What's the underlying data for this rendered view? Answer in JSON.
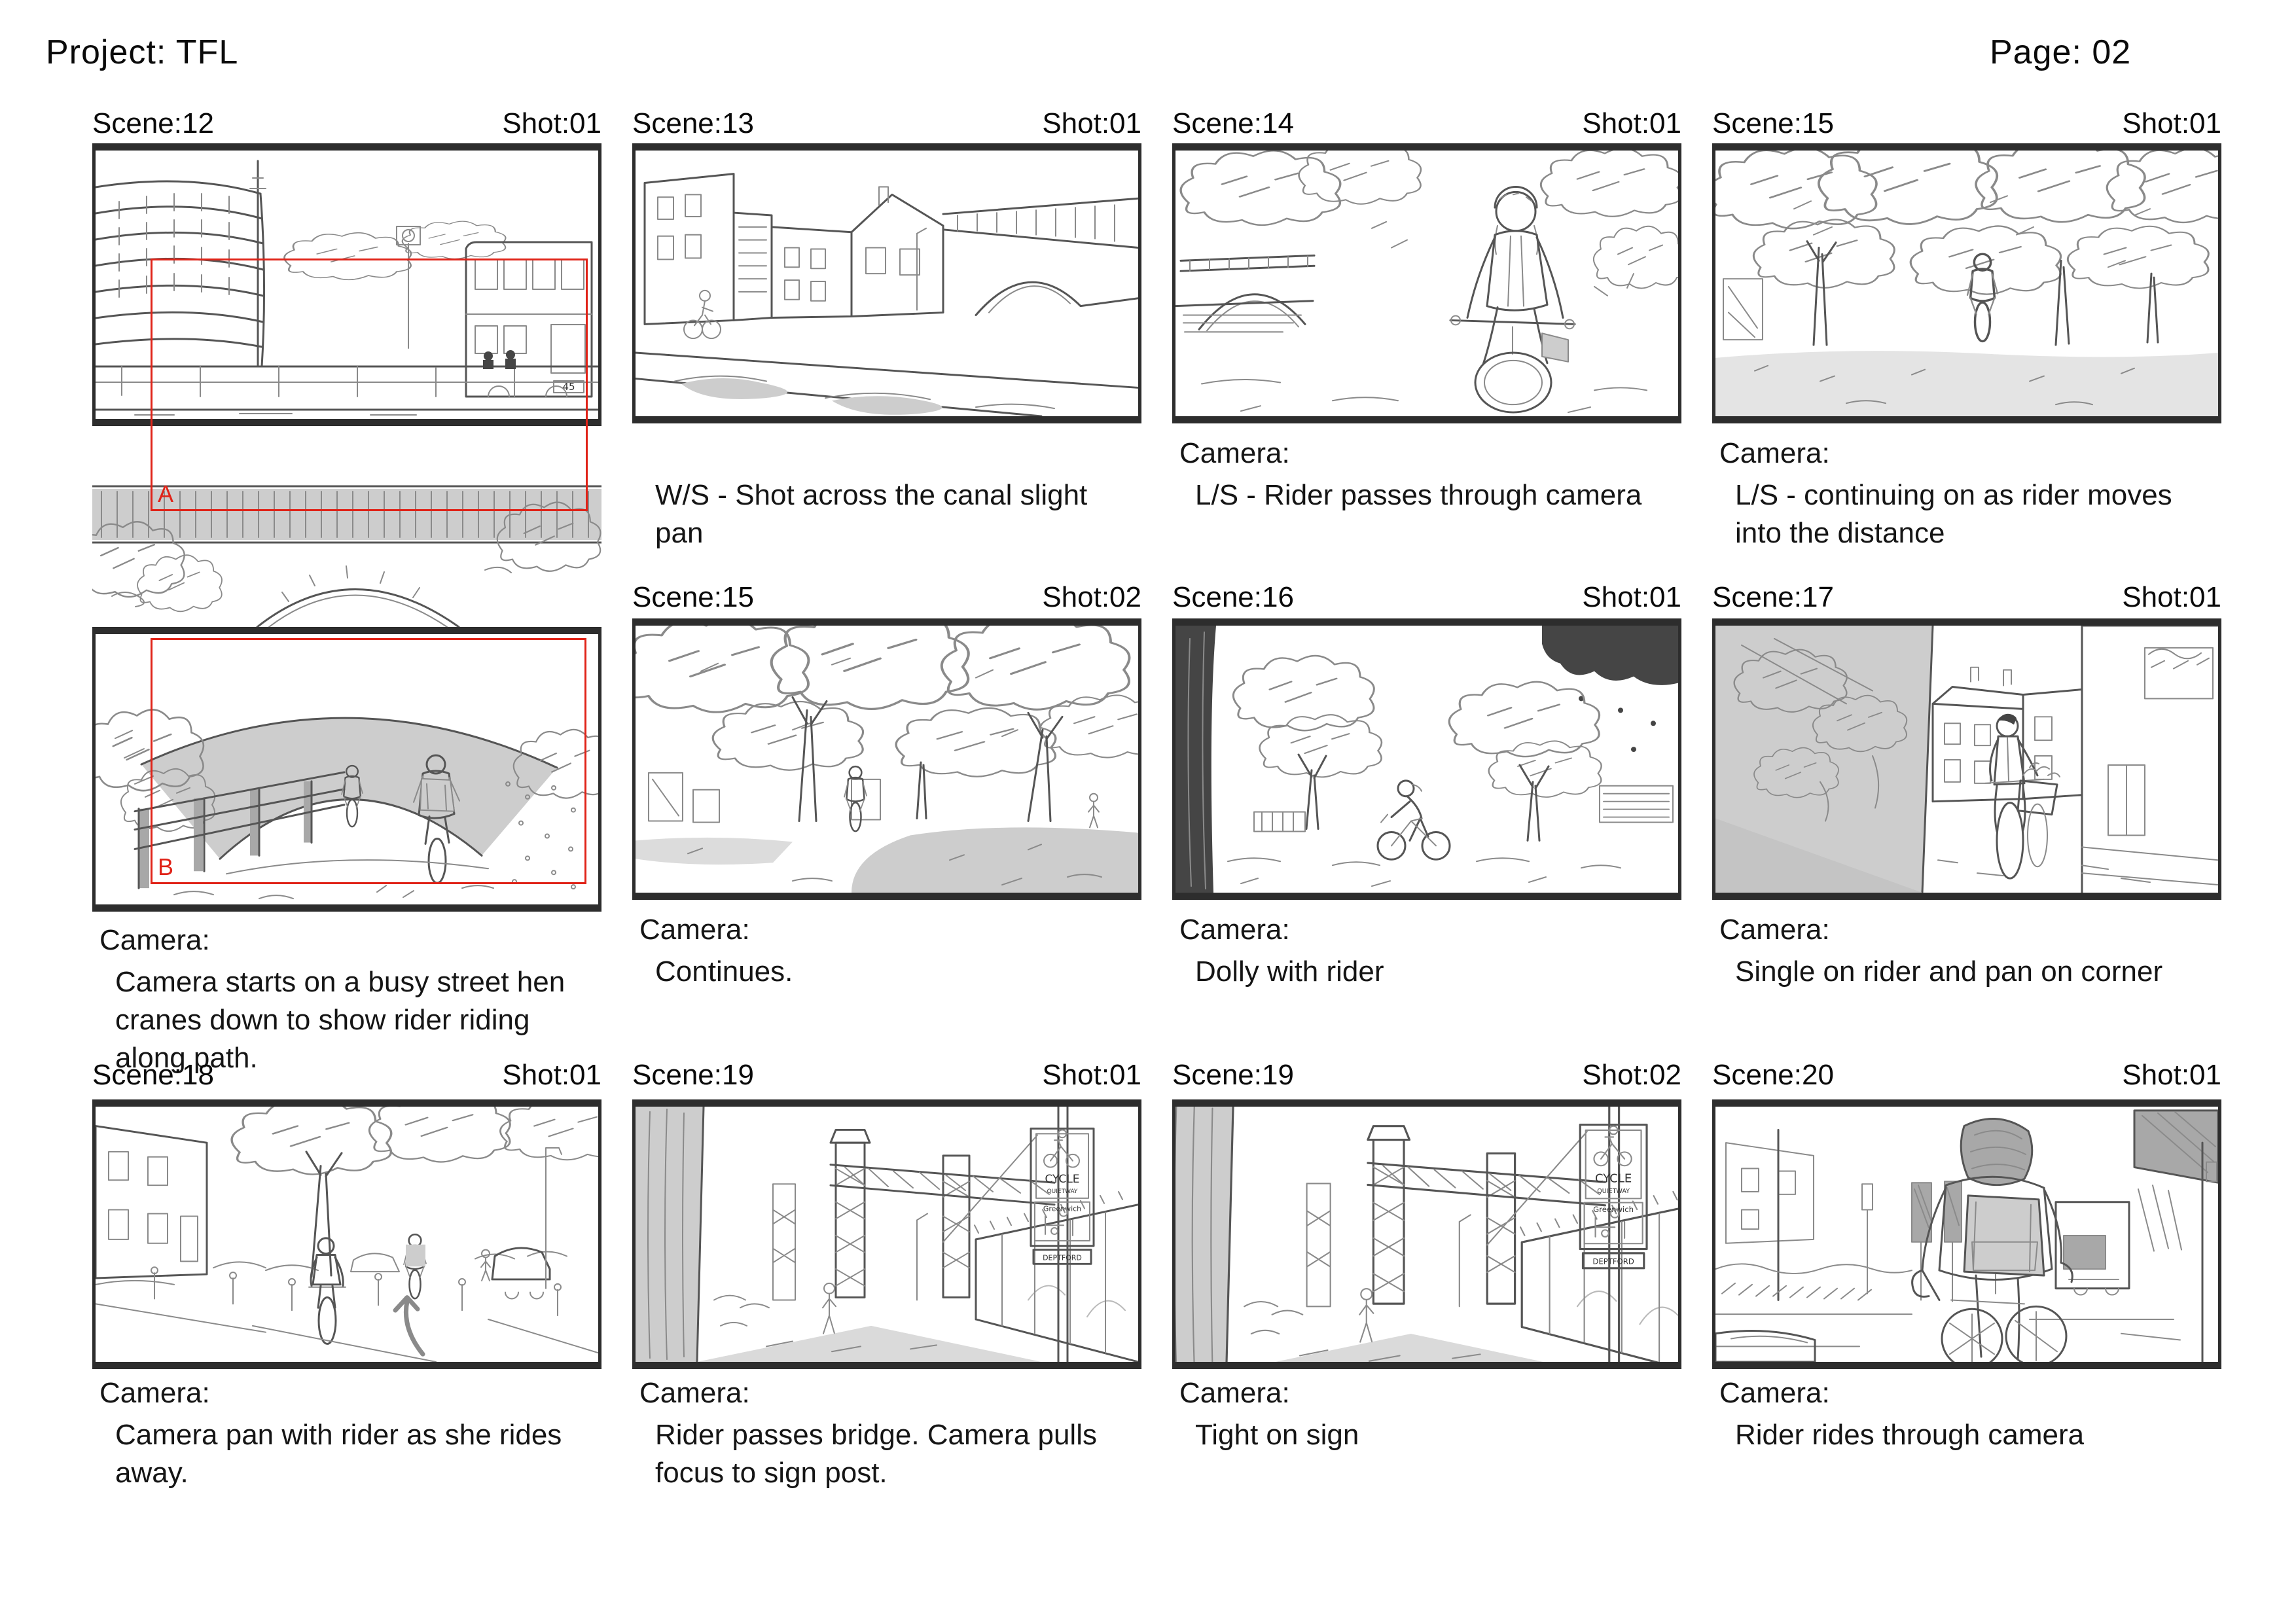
{
  "header": {
    "project_label": "Project: TFL",
    "page_label": "Page: 02"
  },
  "colors": {
    "frame_border": "#2d2d2d",
    "marker_red": "#e02318",
    "sketch_line": "#555555",
    "sketch_shade": "#cdcdcd"
  },
  "panels": [
    {
      "scene": "Scene:12",
      "shot": "Shot:01",
      "camera_label": "Camera:",
      "camera_text": "Camera starts on a busy street hen cranes down to show rider riding along path.",
      "overlay_labels": {
        "frame_a": "A",
        "frame_b": "B"
      },
      "sketch_text": {
        "bus_number": "45"
      }
    },
    {
      "scene": "Scene:13",
      "shot": "Shot:01",
      "camera_label": "",
      "camera_text": "W/S - Shot across the canal slight pan"
    },
    {
      "scene": "Scene:14",
      "shot": "Shot:01",
      "camera_label": "Camera:",
      "camera_text": "L/S - Rider passes through camera"
    },
    {
      "scene": "Scene:15",
      "shot": "Shot:01",
      "camera_label": "Camera:",
      "camera_text": "L/S - continuing on as rider moves into the distance"
    },
    {
      "scene": "Scene:15",
      "shot": "Shot:02",
      "camera_label": "Camera:",
      "camera_text": "Continues."
    },
    {
      "scene": "Scene:16",
      "shot": "Shot:01",
      "camera_label": "Camera:",
      "camera_text": "Dolly with rider"
    },
    {
      "scene": "Scene:17",
      "shot": "Shot:01",
      "camera_label": "Camera:",
      "camera_text": "Single on rider and pan on corner"
    },
    {
      "scene": "Scene:18",
      "shot": "Shot:01",
      "camera_label": "Camera:",
      "camera_text": "Camera pan with rider as she rides away."
    },
    {
      "scene": "Scene:19",
      "shot": "Shot:01",
      "camera_label": "Camera:",
      "camera_text": "Rider passes bridge. Camera pulls focus to sign post.",
      "sketch_text": {
        "sign_line1": "CYCLE",
        "sign_line2": "QUIETWAY",
        "sign_mid": "Greenwich",
        "sign_bottom": "DEPTFORD"
      }
    },
    {
      "scene": "Scene:19",
      "shot": "Shot:02",
      "camera_label": "Camera:",
      "camera_text": "Tight on sign",
      "sketch_text": {
        "sign_line1": "CYCLE",
        "sign_line2": "QUIETWAY",
        "sign_mid": "Greenwich",
        "sign_bottom": "DEPTFORD"
      }
    },
    {
      "scene": "Scene:20",
      "shot": "Shot:01",
      "camera_label": "Camera:",
      "camera_text": "Rider rides through camera"
    }
  ]
}
